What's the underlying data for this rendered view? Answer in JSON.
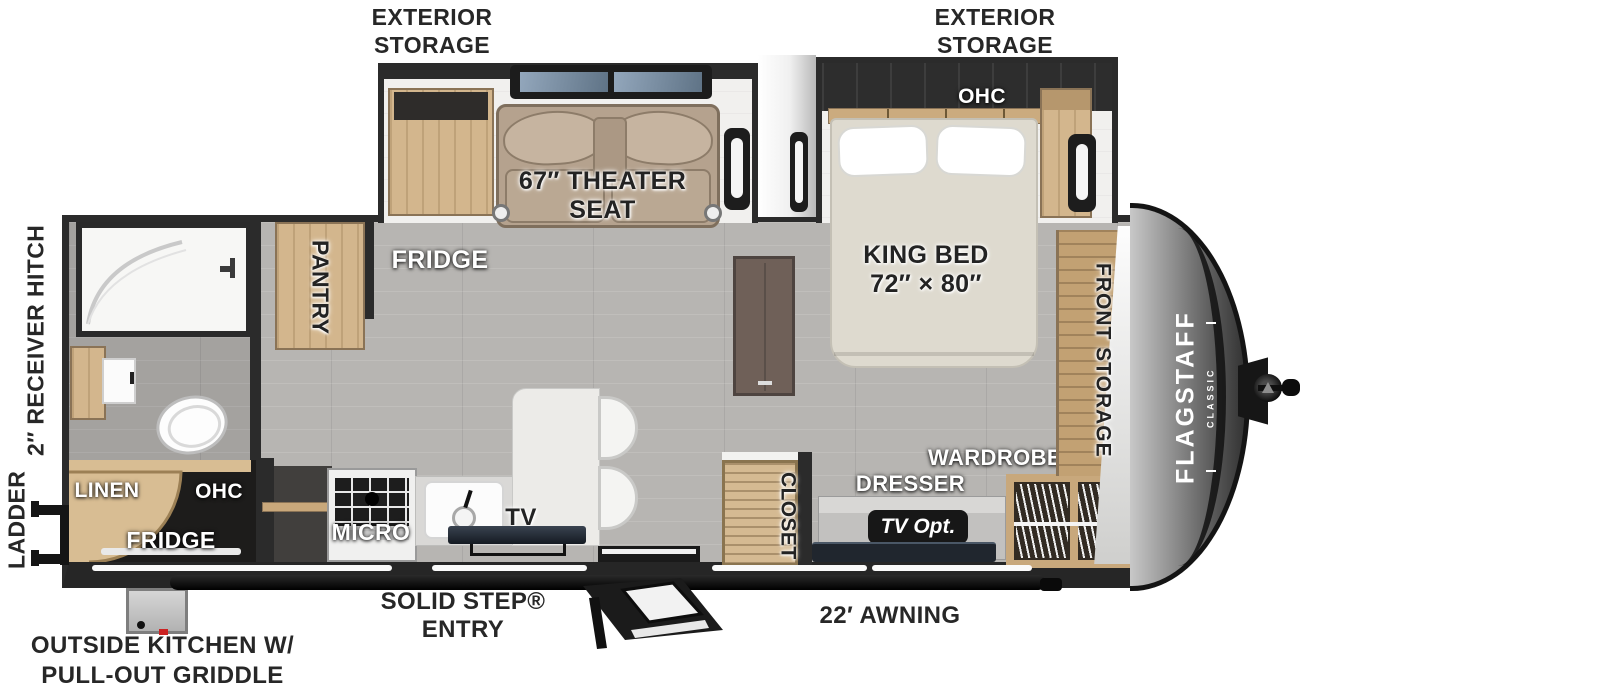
{
  "plan": {
    "brand": {
      "name": "FLAGSTAFF",
      "series": "CLASSIC"
    },
    "callouts_top": {
      "rear": {
        "line1": "EXTERIOR",
        "line2": "STORAGE"
      },
      "front": {
        "line1": "EXTERIOR",
        "line2": "STORAGE"
      }
    },
    "callouts_left": {
      "receiver_hitch": "2″ RECEIVER HITCH",
      "ladder": "LADDER"
    },
    "callouts_bottom": {
      "outside_kitchen_line1": "OUTSIDE KITCHEN W/",
      "outside_kitchen_line2": "PULL-OUT GRIDDLE",
      "entry": "SOLID STEP® ENTRY",
      "awning": "22′ AWNING"
    },
    "living": {
      "theater_line1": "67″ THEATER",
      "theater_line2": "SEAT",
      "fridge": "FRIDGE",
      "pantry": "PANTRY"
    },
    "kitchen": {
      "micro": "MICRO",
      "tv": "TV"
    },
    "outside_kitchen": {
      "linen": "LINEN",
      "ohc": "OHC",
      "fridge": "FRIDGE"
    },
    "bedroom": {
      "ohc": "OHC",
      "bed_line1": "KING BED",
      "bed_line2": "72″ × 80″",
      "front_storage": "FRONT STORAGE",
      "wardrobe": "WARDROBE",
      "dresser": "DRESSER",
      "tv_option": "TV Opt.",
      "closet": "CLOSET"
    }
  },
  "colors": {
    "wall": "#2b2b2b",
    "floor": "#b7b5b2",
    "wood": "#d3b68d",
    "theater_seat": "#b5a28e",
    "front_cap": "#6e6e6e",
    "window_glass": "#7b90a6",
    "badge": "#171717",
    "awning": "#1a1a1a"
  }
}
